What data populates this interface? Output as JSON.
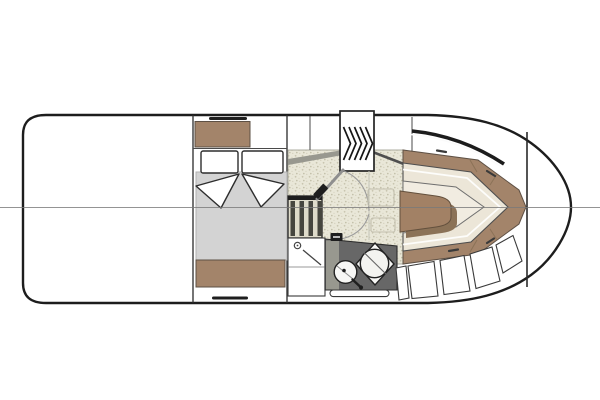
{
  "meta": {
    "type": "yacht-deck-plan",
    "view": "top-down interior floor plan, bow pointing right",
    "visible_text": ""
  },
  "colors": {
    "hull-line": "#1d1d1d",
    "centerline": "#7a7a7a",
    "wood": "#a3846a",
    "wood-dark": "#8b7257",
    "table": "#a28165",
    "cushion": "#ece6d8",
    "cushion-inner": "#f1ece1",
    "floor": "#e9e7d8",
    "floor-dot": "#c9c5af",
    "mattress": "#d3d3d3",
    "counter": "#676767",
    "counter-light": "#98988f",
    "step-dark": "#46463f",
    "step-light": "#dedbca"
  },
  "plan_elements": [
    "hull-outline",
    "centerline",
    "aft-cabin-double-berth",
    "pillows",
    "blanket-fold",
    "dresser",
    "storage-drawers",
    "staircase",
    "companionway-steps",
    "shower-with-drain",
    "marine-toilet",
    "corner-sink",
    "grab-rail",
    "swing-doors",
    "dinette-settee",
    "dinette-table",
    "backrest-cabinets",
    "bow-lockers",
    "windshield"
  ]
}
